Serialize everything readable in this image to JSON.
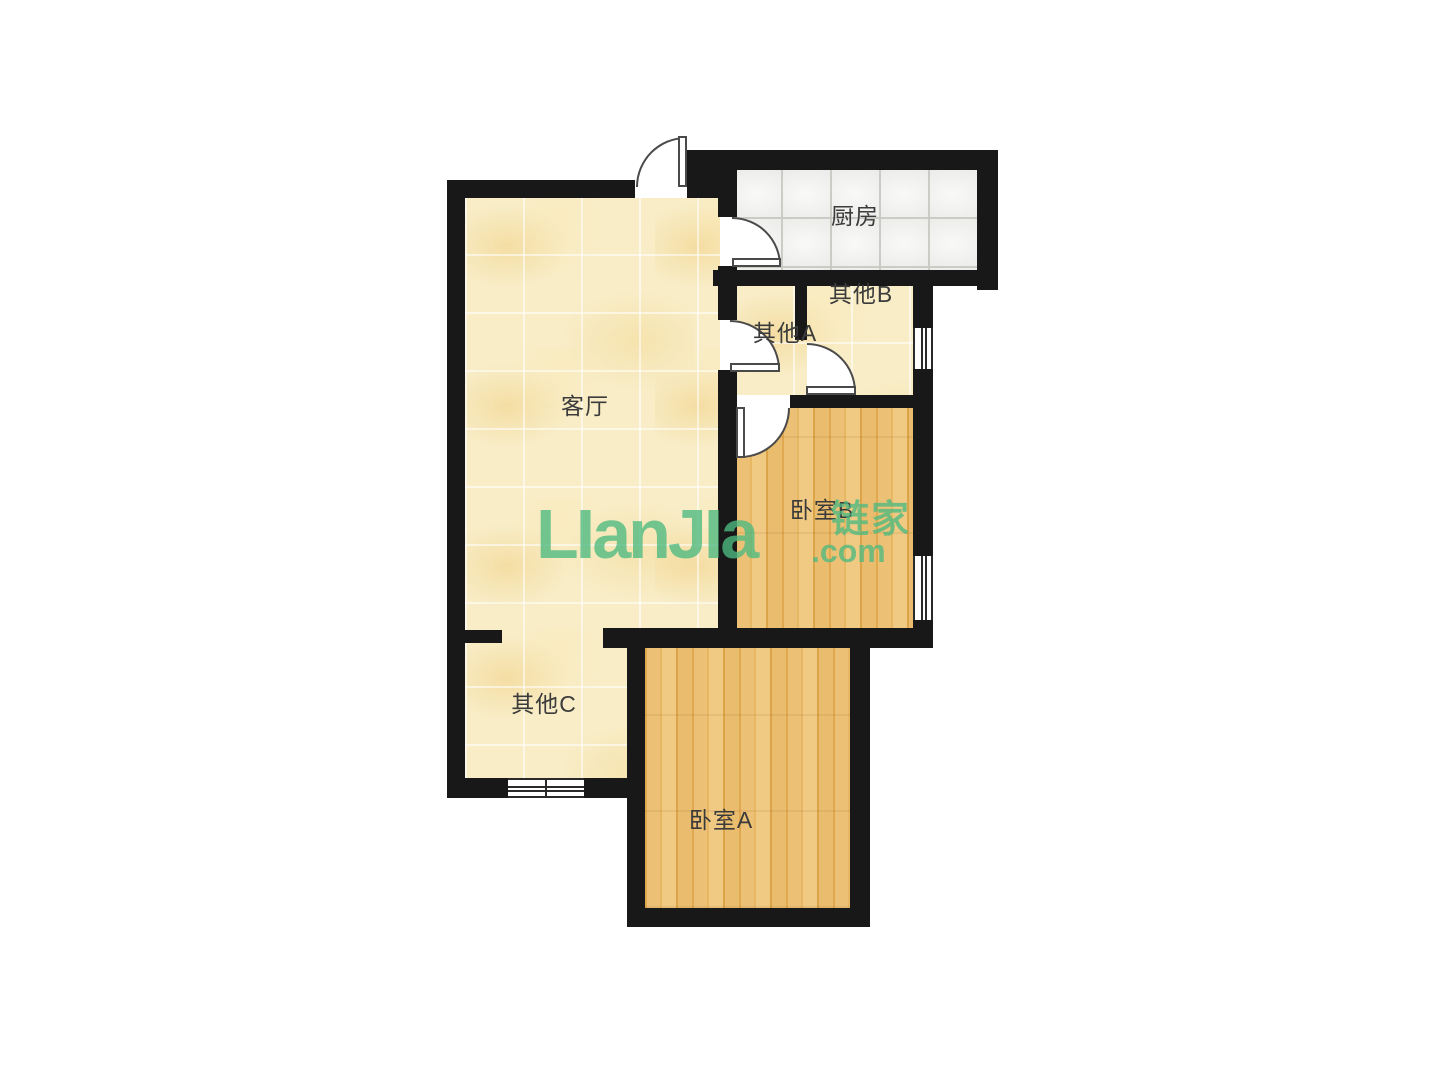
{
  "brand": {
    "logo": "LIanJIa",
    "tld": ".com",
    "cn": "链家"
  },
  "rooms": {
    "living": {
      "label": "客厅"
    },
    "kitchen": {
      "label": "厨房"
    },
    "other_a": {
      "label": "其他A"
    },
    "other_b": {
      "label": "其他B"
    },
    "other_c": {
      "label": "其他C"
    },
    "bedroom_a": {
      "label": "卧室A"
    },
    "bedroom_b": {
      "label": "卧室B"
    }
  },
  "palette": {
    "wall": "#181818",
    "tile_floor": "#f8edc7",
    "wood_floor": "#e9bc6b",
    "kitchen_floor": "#ebebe9",
    "label_text": "#3b3b3b",
    "door_line": "#4a4a4a",
    "watermark": "#4dba81",
    "background": "#ffffff"
  }
}
